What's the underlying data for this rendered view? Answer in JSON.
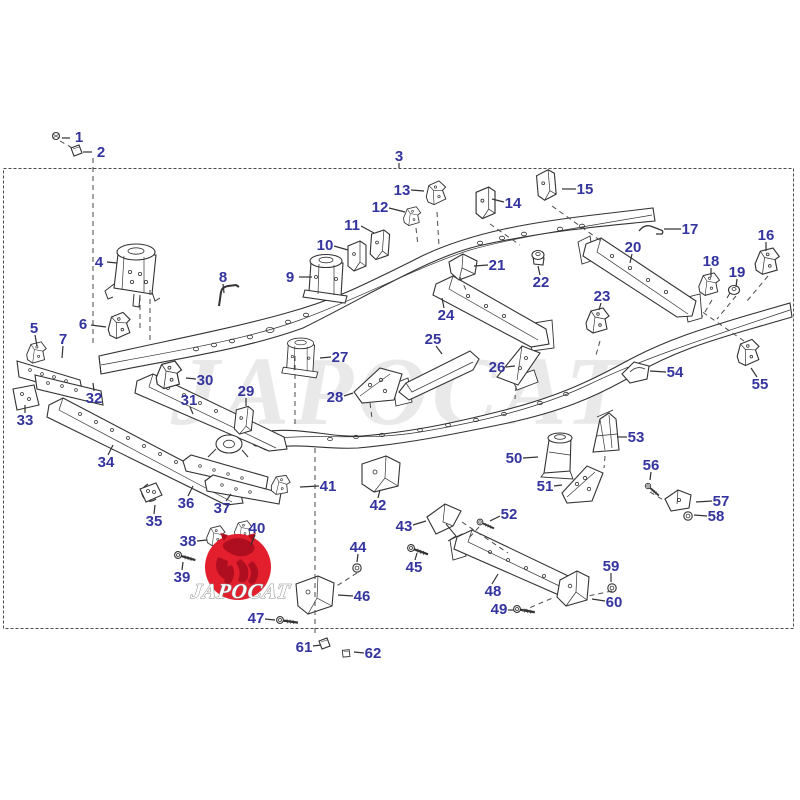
{
  "diagram": {
    "label_color": "#34349e",
    "line_color": "#333333",
    "watermark": {
      "text": "JAPOCAT",
      "color": "#dcdcdc"
    },
    "logo": {
      "text": "JAPOCAT",
      "circle_color": "#e31e2d",
      "mark_color": "#ae0e1f",
      "text_color": "#ffffff",
      "outline_color": "#8a8a8a"
    },
    "labels": [
      {
        "n": "1",
        "x": 79,
        "y": 137,
        "leader": [
          70,
          138,
          62,
          138
        ]
      },
      {
        "n": "2",
        "x": 101,
        "y": 152,
        "leader": [
          92,
          152,
          83,
          152
        ]
      },
      {
        "n": "3",
        "x": 399,
        "y": 156,
        "leader": [
          399,
          163,
          399,
          168
        ]
      },
      {
        "n": "4",
        "x": 99,
        "y": 262,
        "leader": [
          107,
          262,
          117,
          263
        ]
      },
      {
        "n": "5",
        "x": 34,
        "y": 328,
        "leader": [
          35,
          335,
          37,
          346
        ]
      },
      {
        "n": "6",
        "x": 83,
        "y": 324,
        "leader": [
          91,
          325,
          106,
          327
        ]
      },
      {
        "n": "7",
        "x": 63,
        "y": 339,
        "leader": [
          63,
          346,
          62,
          358
        ]
      },
      {
        "n": "8",
        "x": 223,
        "y": 277,
        "leader": [
          223,
          284,
          224,
          293
        ]
      },
      {
        "n": "9",
        "x": 290,
        "y": 277,
        "leader": [
          299,
          277,
          312,
          277
        ]
      },
      {
        "n": "10",
        "x": 325,
        "y": 245,
        "leader": [
          334,
          246,
          348,
          250
        ]
      },
      {
        "n": "11",
        "x": 352,
        "y": 225,
        "leader": [
          361,
          226,
          374,
          233
        ]
      },
      {
        "n": "12",
        "x": 380,
        "y": 207,
        "leader": [
          389,
          208,
          405,
          212
        ]
      },
      {
        "n": "13",
        "x": 402,
        "y": 190,
        "leader": [
          411,
          190,
          424,
          191
        ]
      },
      {
        "n": "14",
        "x": 513,
        "y": 203,
        "leader": [
          504,
          202,
          492,
          199
        ]
      },
      {
        "n": "15",
        "x": 585,
        "y": 189,
        "leader": [
          576,
          189,
          562,
          189
        ]
      },
      {
        "n": "16",
        "x": 766,
        "y": 235,
        "leader": [
          766,
          242,
          766,
          251
        ]
      },
      {
        "n": "17",
        "x": 690,
        "y": 229,
        "leader": [
          681,
          229,
          664,
          229
        ]
      },
      {
        "n": "18",
        "x": 711,
        "y": 261,
        "leader": [
          711,
          268,
          711,
          277
        ]
      },
      {
        "n": "19",
        "x": 737,
        "y": 272,
        "leader": [
          737,
          279,
          736,
          287
        ]
      },
      {
        "n": "20",
        "x": 633,
        "y": 247,
        "leader": [
          632,
          254,
          630,
          263
        ]
      },
      {
        "n": "21",
        "x": 497,
        "y": 265,
        "leader": [
          488,
          265,
          474,
          266
        ]
      },
      {
        "n": "22",
        "x": 541,
        "y": 282,
        "leader": [
          540,
          275,
          538,
          266
        ]
      },
      {
        "n": "23",
        "x": 602,
        "y": 296,
        "leader": [
          601,
          303,
          599,
          310
        ]
      },
      {
        "n": "24",
        "x": 446,
        "y": 315,
        "leader": [
          444,
          308,
          442,
          298
        ]
      },
      {
        "n": "25",
        "x": 433,
        "y": 339,
        "leader": [
          436,
          346,
          442,
          354
        ]
      },
      {
        "n": "26",
        "x": 497,
        "y": 367,
        "leader": [
          506,
          367,
          515,
          366
        ]
      },
      {
        "n": "27",
        "x": 340,
        "y": 357,
        "leader": [
          331,
          357,
          320,
          358
        ]
      },
      {
        "n": "28",
        "x": 335,
        "y": 397,
        "leader": [
          344,
          396,
          353,
          393
        ]
      },
      {
        "n": "29",
        "x": 246,
        "y": 391,
        "leader": [
          246,
          398,
          246,
          406
        ]
      },
      {
        "n": "30",
        "x": 205,
        "y": 380,
        "leader": [
          196,
          379,
          186,
          378
        ]
      },
      {
        "n": "31",
        "x": 189,
        "y": 400,
        "leader": [
          190,
          407,
          193,
          414
        ]
      },
      {
        "n": "32",
        "x": 94,
        "y": 398,
        "leader": [
          94,
          391,
          93,
          383
        ]
      },
      {
        "n": "33",
        "x": 25,
        "y": 420,
        "leader": [
          25,
          413,
          25,
          405
        ]
      },
      {
        "n": "34",
        "x": 106,
        "y": 462,
        "leader": [
          108,
          455,
          113,
          445
        ]
      },
      {
        "n": "35",
        "x": 154,
        "y": 521,
        "leader": [
          154,
          514,
          155,
          505
        ]
      },
      {
        "n": "36",
        "x": 186,
        "y": 503,
        "leader": [
          188,
          496,
          193,
          486
        ]
      },
      {
        "n": "37",
        "x": 222,
        "y": 508,
        "leader": [
          226,
          501,
          231,
          494
        ]
      },
      {
        "n": "38",
        "x": 188,
        "y": 541,
        "leader": [
          197,
          541,
          207,
          540
        ]
      },
      {
        "n": "39",
        "x": 182,
        "y": 577,
        "leader": [
          182,
          570,
          183,
          562
        ]
      },
      {
        "n": "40",
        "x": 257,
        "y": 528,
        "leader": [
          255,
          535,
          251,
          545
        ]
      },
      {
        "n": "41",
        "x": 328,
        "y": 486,
        "leader": [
          319,
          486,
          300,
          487
        ]
      },
      {
        "n": "42",
        "x": 378,
        "y": 505,
        "leader": [
          378,
          498,
          380,
          490
        ]
      },
      {
        "n": "43",
        "x": 404,
        "y": 526,
        "leader": [
          413,
          525,
          426,
          521
        ]
      },
      {
        "n": "44",
        "x": 358,
        "y": 547,
        "leader": [
          358,
          554,
          357,
          562
        ]
      },
      {
        "n": "45",
        "x": 414,
        "y": 567,
        "leader": [
          415,
          560,
          417,
          553
        ]
      },
      {
        "n": "46",
        "x": 362,
        "y": 596,
        "leader": [
          353,
          596,
          338,
          595
        ]
      },
      {
        "n": "47",
        "x": 256,
        "y": 618,
        "leader": [
          265,
          619,
          275,
          620
        ]
      },
      {
        "n": "48",
        "x": 493,
        "y": 591,
        "leader": [
          492,
          584,
          498,
          574
        ]
      },
      {
        "n": "49",
        "x": 499,
        "y": 609,
        "leader": [
          508,
          610,
          514,
          610
        ]
      },
      {
        "n": "50",
        "x": 514,
        "y": 458,
        "leader": [
          523,
          458,
          538,
          457
        ]
      },
      {
        "n": "51",
        "x": 545,
        "y": 486,
        "leader": [
          554,
          486,
          562,
          485
        ]
      },
      {
        "n": "52",
        "x": 509,
        "y": 514,
        "leader": [
          500,
          516,
          490,
          521
        ]
      },
      {
        "n": "53",
        "x": 636,
        "y": 437,
        "leader": [
          627,
          437,
          617,
          437
        ]
      },
      {
        "n": "54",
        "x": 675,
        "y": 372,
        "leader": [
          666,
          372,
          650,
          371
        ]
      },
      {
        "n": "55",
        "x": 760,
        "y": 384,
        "leader": [
          757,
          377,
          751,
          368
        ]
      },
      {
        "n": "56",
        "x": 651,
        "y": 465,
        "leader": [
          651,
          472,
          650,
          480
        ]
      },
      {
        "n": "57",
        "x": 721,
        "y": 501,
        "leader": [
          712,
          501,
          696,
          502
        ]
      },
      {
        "n": "58",
        "x": 716,
        "y": 516,
        "leader": [
          707,
          516,
          694,
          515
        ]
      },
      {
        "n": "59",
        "x": 611,
        "y": 566,
        "leader": [
          611,
          573,
          611,
          582
        ]
      },
      {
        "n": "60",
        "x": 614,
        "y": 602,
        "leader": [
          605,
          601,
          592,
          599
        ]
      },
      {
        "n": "61",
        "x": 304,
        "y": 647,
        "leader": [
          313,
          646,
          321,
          645
        ]
      },
      {
        "n": "62",
        "x": 373,
        "y": 653,
        "leader": [
          364,
          653,
          354,
          652
        ]
      }
    ]
  }
}
